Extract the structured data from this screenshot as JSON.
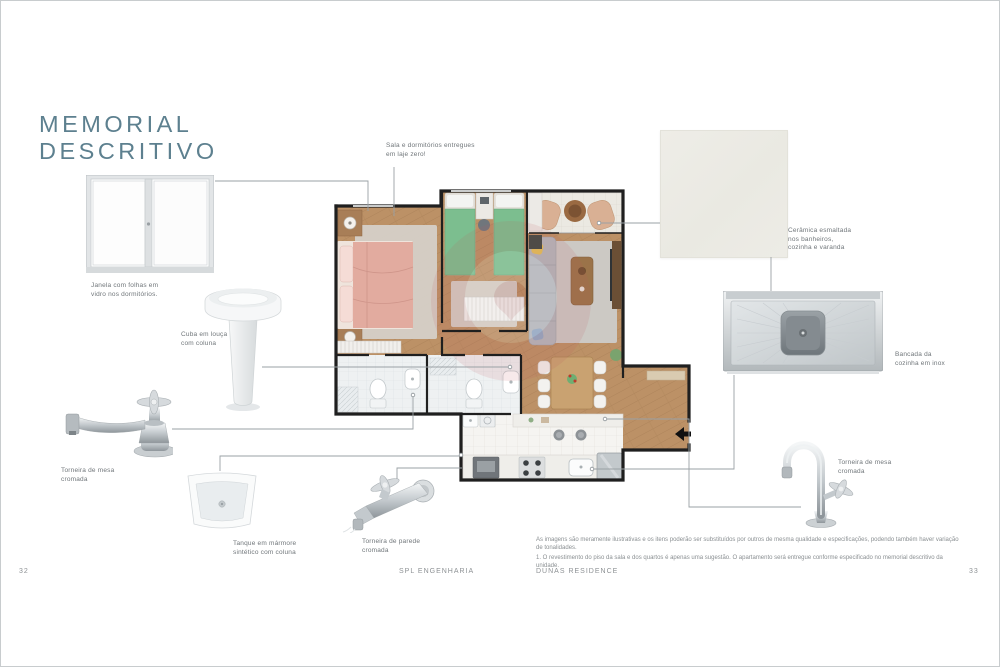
{
  "page": {
    "title_line1": "MEMORIAL",
    "title_line2": "DESCRITIVO",
    "accent_color": "#5d808f"
  },
  "plan": {
    "note": "Sala e dormitórios entregues em laje zero!"
  },
  "items": {
    "window": {
      "label": "Janela com folhas em vidro nos dormitórios."
    },
    "pedestal_sink": {
      "label": "Cuba em louça com coluna"
    },
    "faucet_left": {
      "label": "Torneira de mesa cromada"
    },
    "tank": {
      "label": "Tanque em mármore sintético com coluna"
    },
    "wall_faucet": {
      "label": "Torneira de parede cromada"
    },
    "ceramic": {
      "label": "Cerâmica esmaltada nos banheiros, cozinha e varanda"
    },
    "countertop": {
      "label": "Bancada da cozinha em inox"
    },
    "faucet_right": {
      "label": "Torneira de mesa cromada"
    }
  },
  "disclaimer": {
    "para1": "As imagens são meramente ilustrativas e os itens poderão ser substituídos por outros de mesma qualidade e especificações, podendo também haver variação de tonalidades.",
    "para2": "1. O revestimento do piso da sala e dos quartos é apenas uma sugestão. O apartamento será entregue conforme especificado no memorial descritivo da unidade."
  },
  "footer": {
    "page_left": "32",
    "company": "SPL ENGENHARIA",
    "project": "DUNAS RESIDENCE",
    "page_right": "33"
  }
}
